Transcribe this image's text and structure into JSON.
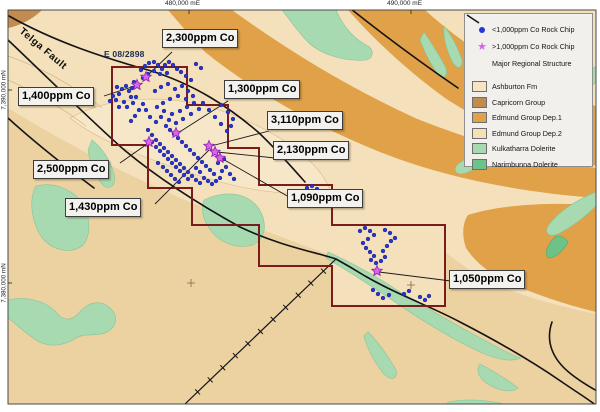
{
  "axis": {
    "top": [
      {
        "text": "480,000 mE"
      },
      {
        "text": "490,000 mE"
      }
    ],
    "left": [
      {
        "text": "7,390,000 mN"
      },
      {
        "text": "7,380,000 mN"
      }
    ]
  },
  "map": {
    "tenement_label": "E 08/2898",
    "fault_label": "Telga Fault",
    "callouts": [
      {
        "label": "1,400ppm Co"
      },
      {
        "label": "2,300ppm Co"
      },
      {
        "label": "1,300ppm Co"
      },
      {
        "label": "3,110ppm Co"
      },
      {
        "label": "2,130ppm Co"
      },
      {
        "label": "1,090ppm Co"
      },
      {
        "label": "2,500ppm Co"
      },
      {
        "label": "1,430ppm Co"
      },
      {
        "label": "1,050ppm Co"
      }
    ]
  },
  "legend": {
    "symbols": [
      {
        "icon": "blue-dot",
        "label": "<1,000ppm Co Rock Chip"
      },
      {
        "icon": "magenta-star",
        "label": ">1,000ppm Co Rock Chip"
      },
      {
        "icon": "black-line",
        "label": "Major Regional Structure"
      }
    ],
    "units": [
      {
        "label": "Ashburton Fm",
        "color": "#f7e4c2"
      },
      {
        "label": "Capricorn Group",
        "color": "#c28c50"
      },
      {
        "label": "Edmund Group Dep.1",
        "color": "#e0a148"
      },
      {
        "label": "Edmund Group Dep.2",
        "color": "#f6e0b8"
      },
      {
        "label": "Kulkatharra Dolerite",
        "color": "#a8dab2"
      },
      {
        "label": "Narimbunna Dolerite",
        "color": "#6cc287"
      }
    ]
  },
  "samples": {
    "low_grade_points": [
      [
        116,
        100
      ],
      [
        119,
        94
      ],
      [
        122,
        89
      ],
      [
        126,
        86
      ],
      [
        129,
        91
      ],
      [
        131,
        97
      ],
      [
        124,
        102
      ],
      [
        119,
        107
      ],
      [
        127,
        107
      ],
      [
        133,
        103
      ],
      [
        136,
        97
      ],
      [
        132,
        88
      ],
      [
        134,
        82
      ],
      [
        117,
        87
      ],
      [
        113,
        96
      ],
      [
        110,
        101
      ],
      [
        141,
        70
      ],
      [
        145,
        66
      ],
      [
        149,
        63
      ],
      [
        154,
        62
      ],
      [
        158,
        65
      ],
      [
        162,
        69
      ],
      [
        165,
        65
      ],
      [
        169,
        62
      ],
      [
        173,
        65
      ],
      [
        177,
        69
      ],
      [
        160,
        74
      ],
      [
        154,
        71
      ],
      [
        148,
        74
      ],
      [
        143,
        78
      ],
      [
        167,
        73
      ],
      [
        181,
        72
      ],
      [
        186,
        76
      ],
      [
        191,
        80
      ],
      [
        196,
        64
      ],
      [
        201,
        68
      ],
      [
        155,
        91
      ],
      [
        161,
        87
      ],
      [
        168,
        84
      ],
      [
        175,
        89
      ],
      [
        182,
        86
      ],
      [
        188,
        91
      ],
      [
        193,
        96
      ],
      [
        186,
        99
      ],
      [
        178,
        96
      ],
      [
        170,
        99
      ],
      [
        163,
        103
      ],
      [
        157,
        107
      ],
      [
        164,
        111
      ],
      [
        172,
        114
      ],
      [
        180,
        111
      ],
      [
        187,
        107
      ],
      [
        194,
        103
      ],
      [
        199,
        109
      ],
      [
        191,
        114
      ],
      [
        183,
        119
      ],
      [
        176,
        123
      ],
      [
        169,
        120
      ],
      [
        161,
        117
      ],
      [
        156,
        122
      ],
      [
        150,
        117
      ],
      [
        146,
        110
      ],
      [
        143,
        104
      ],
      [
        139,
        110
      ],
      [
        135,
        116
      ],
      [
        131,
        121
      ],
      [
        203,
        103
      ],
      [
        209,
        110
      ],
      [
        215,
        117
      ],
      [
        221,
        124
      ],
      [
        227,
        131
      ],
      [
        221,
        105
      ],
      [
        228,
        112
      ],
      [
        233,
        119
      ],
      [
        231,
        126
      ],
      [
        148,
        130
      ],
      [
        152,
        135
      ],
      [
        156,
        140
      ],
      [
        160,
        144
      ],
      [
        164,
        148
      ],
      [
        168,
        152
      ],
      [
        172,
        156
      ],
      [
        176,
        160
      ],
      [
        180,
        164
      ],
      [
        184,
        168
      ],
      [
        188,
        172
      ],
      [
        192,
        176
      ],
      [
        196,
        180
      ],
      [
        200,
        183
      ],
      [
        152,
        142
      ],
      [
        156,
        147
      ],
      [
        160,
        151
      ],
      [
        164,
        155
      ],
      [
        168,
        159
      ],
      [
        172,
        163
      ],
      [
        176,
        167
      ],
      [
        180,
        171
      ],
      [
        184,
        175
      ],
      [
        188,
        179
      ],
      [
        158,
        163
      ],
      [
        163,
        167
      ],
      [
        167,
        171
      ],
      [
        171,
        175
      ],
      [
        175,
        179
      ],
      [
        179,
        182
      ],
      [
        204,
        178
      ],
      [
        208,
        181
      ],
      [
        212,
        184
      ],
      [
        216,
        181
      ],
      [
        220,
        178
      ],
      [
        214,
        174
      ],
      [
        210,
        170
      ],
      [
        206,
        166
      ],
      [
        202,
        162
      ],
      [
        198,
        158
      ],
      [
        194,
        154
      ],
      [
        190,
        150
      ],
      [
        186,
        146
      ],
      [
        182,
        142
      ],
      [
        178,
        138
      ],
      [
        174,
        134
      ],
      [
        170,
        130
      ],
      [
        166,
        126
      ],
      [
        196,
        168
      ],
      [
        200,
        172
      ],
      [
        222,
        171
      ],
      [
        226,
        167
      ],
      [
        218,
        163
      ],
      [
        224,
        159
      ],
      [
        230,
        174
      ],
      [
        234,
        179
      ],
      [
        307,
        188
      ],
      [
        312,
        186
      ],
      [
        317,
        189
      ],
      [
        322,
        192
      ],
      [
        327,
        191
      ],
      [
        330,
        196
      ],
      [
        332,
        201
      ],
      [
        328,
        204
      ],
      [
        321,
        200
      ],
      [
        315,
        195
      ],
      [
        360,
        231
      ],
      [
        365,
        228
      ],
      [
        370,
        231
      ],
      [
        374,
        235
      ],
      [
        368,
        239
      ],
      [
        363,
        243
      ],
      [
        366,
        248
      ],
      [
        370,
        252
      ],
      [
        374,
        256
      ],
      [
        371,
        260
      ],
      [
        376,
        263
      ],
      [
        381,
        261
      ],
      [
        385,
        257
      ],
      [
        383,
        251
      ],
      [
        387,
        246
      ],
      [
        391,
        241
      ],
      [
        395,
        238
      ],
      [
        390,
        233
      ],
      [
        385,
        230
      ],
      [
        373,
        290
      ],
      [
        378,
        294
      ],
      [
        383,
        298
      ],
      [
        389,
        295
      ],
      [
        404,
        294
      ],
      [
        409,
        291
      ],
      [
        420,
        297
      ],
      [
        425,
        300
      ],
      [
        429,
        296
      ]
    ],
    "high_grade_points": [
      [
        137,
        85
      ],
      [
        146,
        77
      ],
      [
        176,
        133
      ],
      [
        149,
        142
      ],
      [
        209,
        146
      ],
      [
        215,
        152
      ],
      [
        220,
        158
      ],
      [
        377,
        271
      ]
    ]
  },
  "colors": {
    "tenement_boundary": "#7b1c1c",
    "rock_chip_low": "#2636d8",
    "rock_chip_high": "#d764ea",
    "rock_chip_high_edge": "#8c1fae",
    "structure_line": "#141414"
  }
}
